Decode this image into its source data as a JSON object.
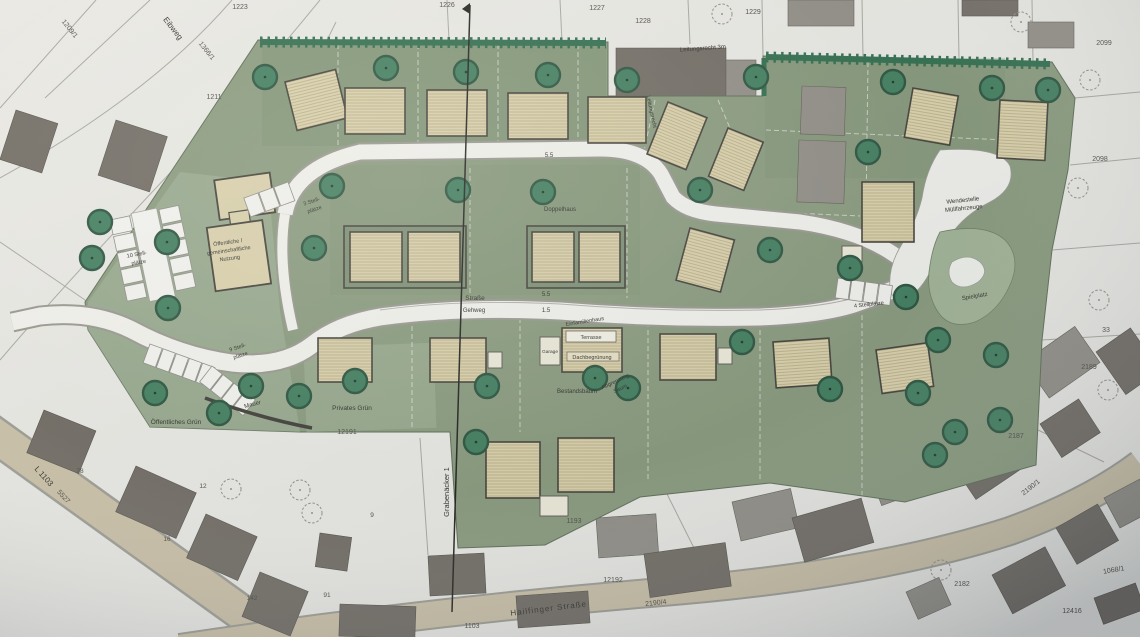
{
  "plan": {
    "streets": {
      "eibweg": "Eibweg",
      "hailfinger_strasse": "Hailfinger Straße",
      "l1103": "L 1103",
      "grabenaecker": "Grabenäcker 1"
    },
    "roads": {
      "strasse": "Straße",
      "gehweg": "Gehweg",
      "width_upper": "5.5",
      "width_lower": "5.5",
      "width_gehweg": "1.5"
    },
    "areas": {
      "oeffentliches_gruen": "Öffentliches Grün",
      "privates_gruen": "Privates Grün",
      "spielplatz": "Spielplatz",
      "wendestelle_line1": "Wendestelle",
      "wendestelle_line2": "Müllfahrzeuge",
      "mauer": "Mauer",
      "leitungsrecht_3m": "Leitungsrecht 3m",
      "leitungsrecht": "Leitungsrecht",
      "abgrenzung_line1": "Abgrenzung",
      "abgrenzung_line2": "Saum",
      "bestandsbaum": "Bestandsbaum"
    },
    "buildings": {
      "doppelhaus": "Doppelhaus",
      "einfamilienhaus": "Einfamilienhaus",
      "terrasse": "Terrasse",
      "garage": "Garage",
      "dachbegruenung": "Dachbegrünung",
      "nutzung_line1": "Öffentliche /",
      "nutzung_line2": "gemeinschaftliche",
      "nutzung_line3": "Nutzung"
    },
    "parking": {
      "p10_line1": "10 Stell-",
      "p10_line2": "plätze",
      "p9_line1": "9 Stell-",
      "p9_line2": "plätze",
      "p3_line1": "3 Stell-",
      "p3_line2": "plätze",
      "p4": "4 Stellplätze"
    },
    "parcels": {
      "p1223": "1223",
      "p1226": "1226",
      "p1227": "1227",
      "p1228": "1228",
      "p1229": "1229",
      "p1211": "1211",
      "p1366_1": "1366/1",
      "p1209_1": "1209/1",
      "p2099": "2099",
      "p2098": "2098",
      "p33": "33",
      "p2189": "2189",
      "p2187": "2187",
      "p2190_1": "2190/1",
      "p2190_4": "2190/4",
      "p2182": "2182",
      "p1068_1": "1068/1",
      "p12416": "12416",
      "p12191": "12191",
      "p12192": "12192",
      "p1193": "1193",
      "p1103": "1103",
      "p5527": "5527"
    },
    "house_numbers": {
      "h142": "142",
      "h91": "91",
      "h12": "12",
      "h78": "78",
      "h16": "16",
      "h9": "9"
    },
    "colors": {
      "development_green": "#87997c",
      "hedge_green": "#2d6b4c",
      "tree_green": "#3e7c5d",
      "house_beige": "#d9d0ab",
      "existing_building": "#6e6962",
      "road_white": "#f1f1ed",
      "country_road_tan": "#c9bfa6",
      "background": "#e8e8e4"
    }
  }
}
